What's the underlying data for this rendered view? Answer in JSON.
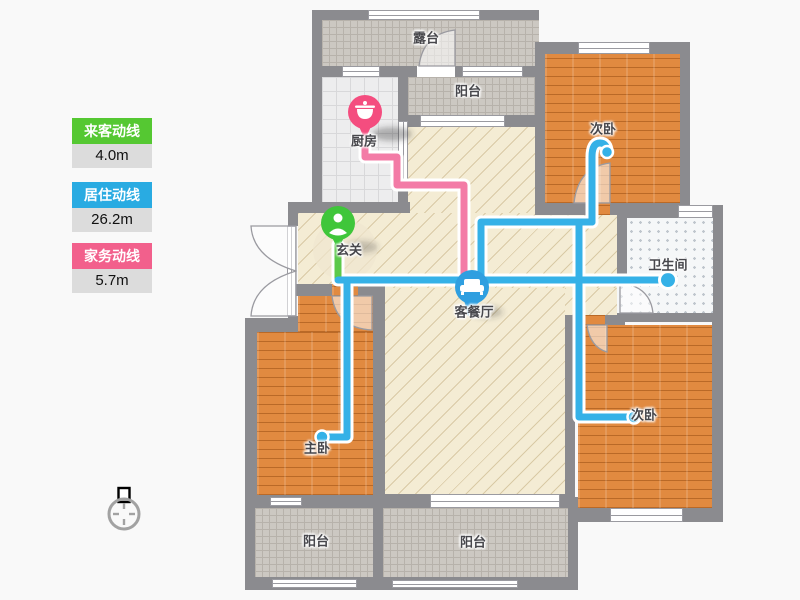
{
  "legend": {
    "items": [
      {
        "label": "来客动线",
        "value": "4.0m",
        "color": "#55c832"
      },
      {
        "label": "居住动线",
        "value": "26.2m",
        "color": "#29abe2"
      },
      {
        "label": "家务动线",
        "value": "5.7m",
        "color": "#f2608c"
      }
    ]
  },
  "rooms": {
    "terrace": "露台",
    "balcony_top": "阳台",
    "kitchen": "厨房",
    "bedroom_top_right": "次卧",
    "entry": "玄关",
    "bathroom": "卫生间",
    "living": "客餐厅",
    "master_bedroom": "主卧",
    "bedroom_bottom_right": "次卧",
    "balcony_bottom_left": "阳台",
    "balcony_bottom_right": "阳台"
  },
  "colors": {
    "wall": "#8b8b8f",
    "route_guest_green": "#5cc94a",
    "route_living_blue": "#35b1e7",
    "route_chore_pink": "#f37ba6",
    "pin_kitchen": "#f44d7f",
    "pin_entry": "#3fc63a",
    "pin_living": "#2f9fe0",
    "wood_floor": "#e18a40",
    "living_floor": "#f4ecd4"
  }
}
